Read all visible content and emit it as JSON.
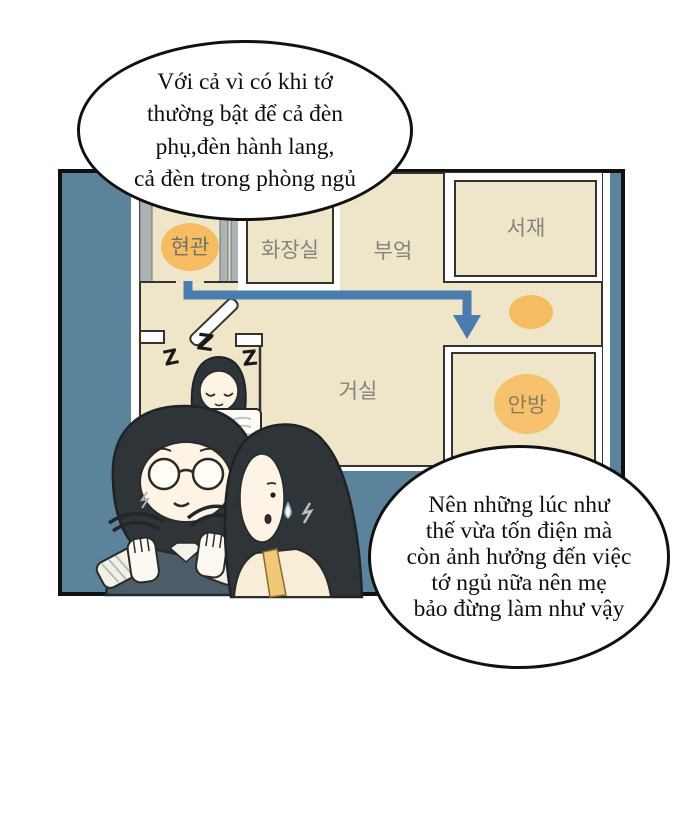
{
  "speech_bubbles": {
    "top": {
      "lines": [
        "Với cả vì có khi tớ",
        "thường bật để cả đèn",
        "phụ,đèn hành lang,",
        "cả đèn trong phòng ngủ"
      ]
    },
    "bottom": {
      "lines": [
        "Nên những lúc như",
        "thế vừa tốn điện mà",
        "còn ảnh hưởng đến việc",
        "tớ ngủ nữa nên mẹ",
        "bảo đừng làm như vậy"
      ]
    }
  },
  "floor_plan": {
    "rooms": {
      "entrance": {
        "label": "현관"
      },
      "bathroom": {
        "label": "화장실"
      },
      "kitchen": {
        "label": "부엌"
      },
      "study": {
        "label": "서재"
      },
      "living_room": {
        "label": "거실"
      },
      "master_bedroom": {
        "label": "안방"
      }
    },
    "sleep_sounds": [
      "Z",
      "Z",
      "Z"
    ]
  },
  "colors": {
    "panel_blue": "#5b839b",
    "floor_cream": "#efe5c9",
    "wall_dark": "#34332f",
    "highlight_orange": "#f6bc62",
    "arrow_blue": "#4a7dad",
    "label_gray": "#83867c",
    "hair_dark": "#2f3438",
    "vest_slate": "#4c5c68",
    "skin": "#fdf4e6"
  }
}
